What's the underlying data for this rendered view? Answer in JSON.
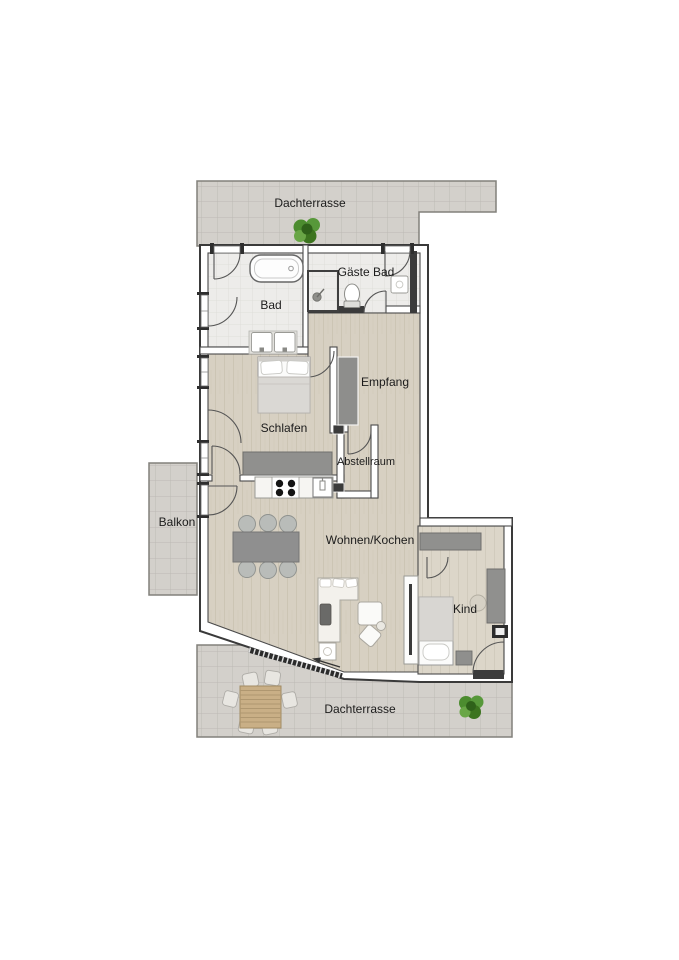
{
  "rooms": {
    "dachterrasse_top": "Dachterrasse",
    "gaeste_bad": "Gäste Bad",
    "bad": "Bad",
    "schlafen": "Schlafen",
    "empfang": "Empfang",
    "abstellraum": "Abstellraum",
    "balkon": "Balkon",
    "wohnen_kochen": "Wohnen/Kochen",
    "kind": "Kind",
    "dachterrasse_bottom": "Dachterrasse"
  },
  "colors": {
    "background": "#ffffff",
    "wall_fill": "#ffffff",
    "wall_outline": "#3a3a3a",
    "floor_wood": "#d7d0c2",
    "floor_wood_light": "#dcd6c9",
    "floor_tile_bath": "#edecea",
    "floor_tile_outdoor": "#d3d0cb",
    "furniture_gray": "#8f8f8d",
    "dark_fixture": "#3b3b3b",
    "plant_green": "#4c8c2f",
    "outdoor_wood": "#c9af86"
  }
}
